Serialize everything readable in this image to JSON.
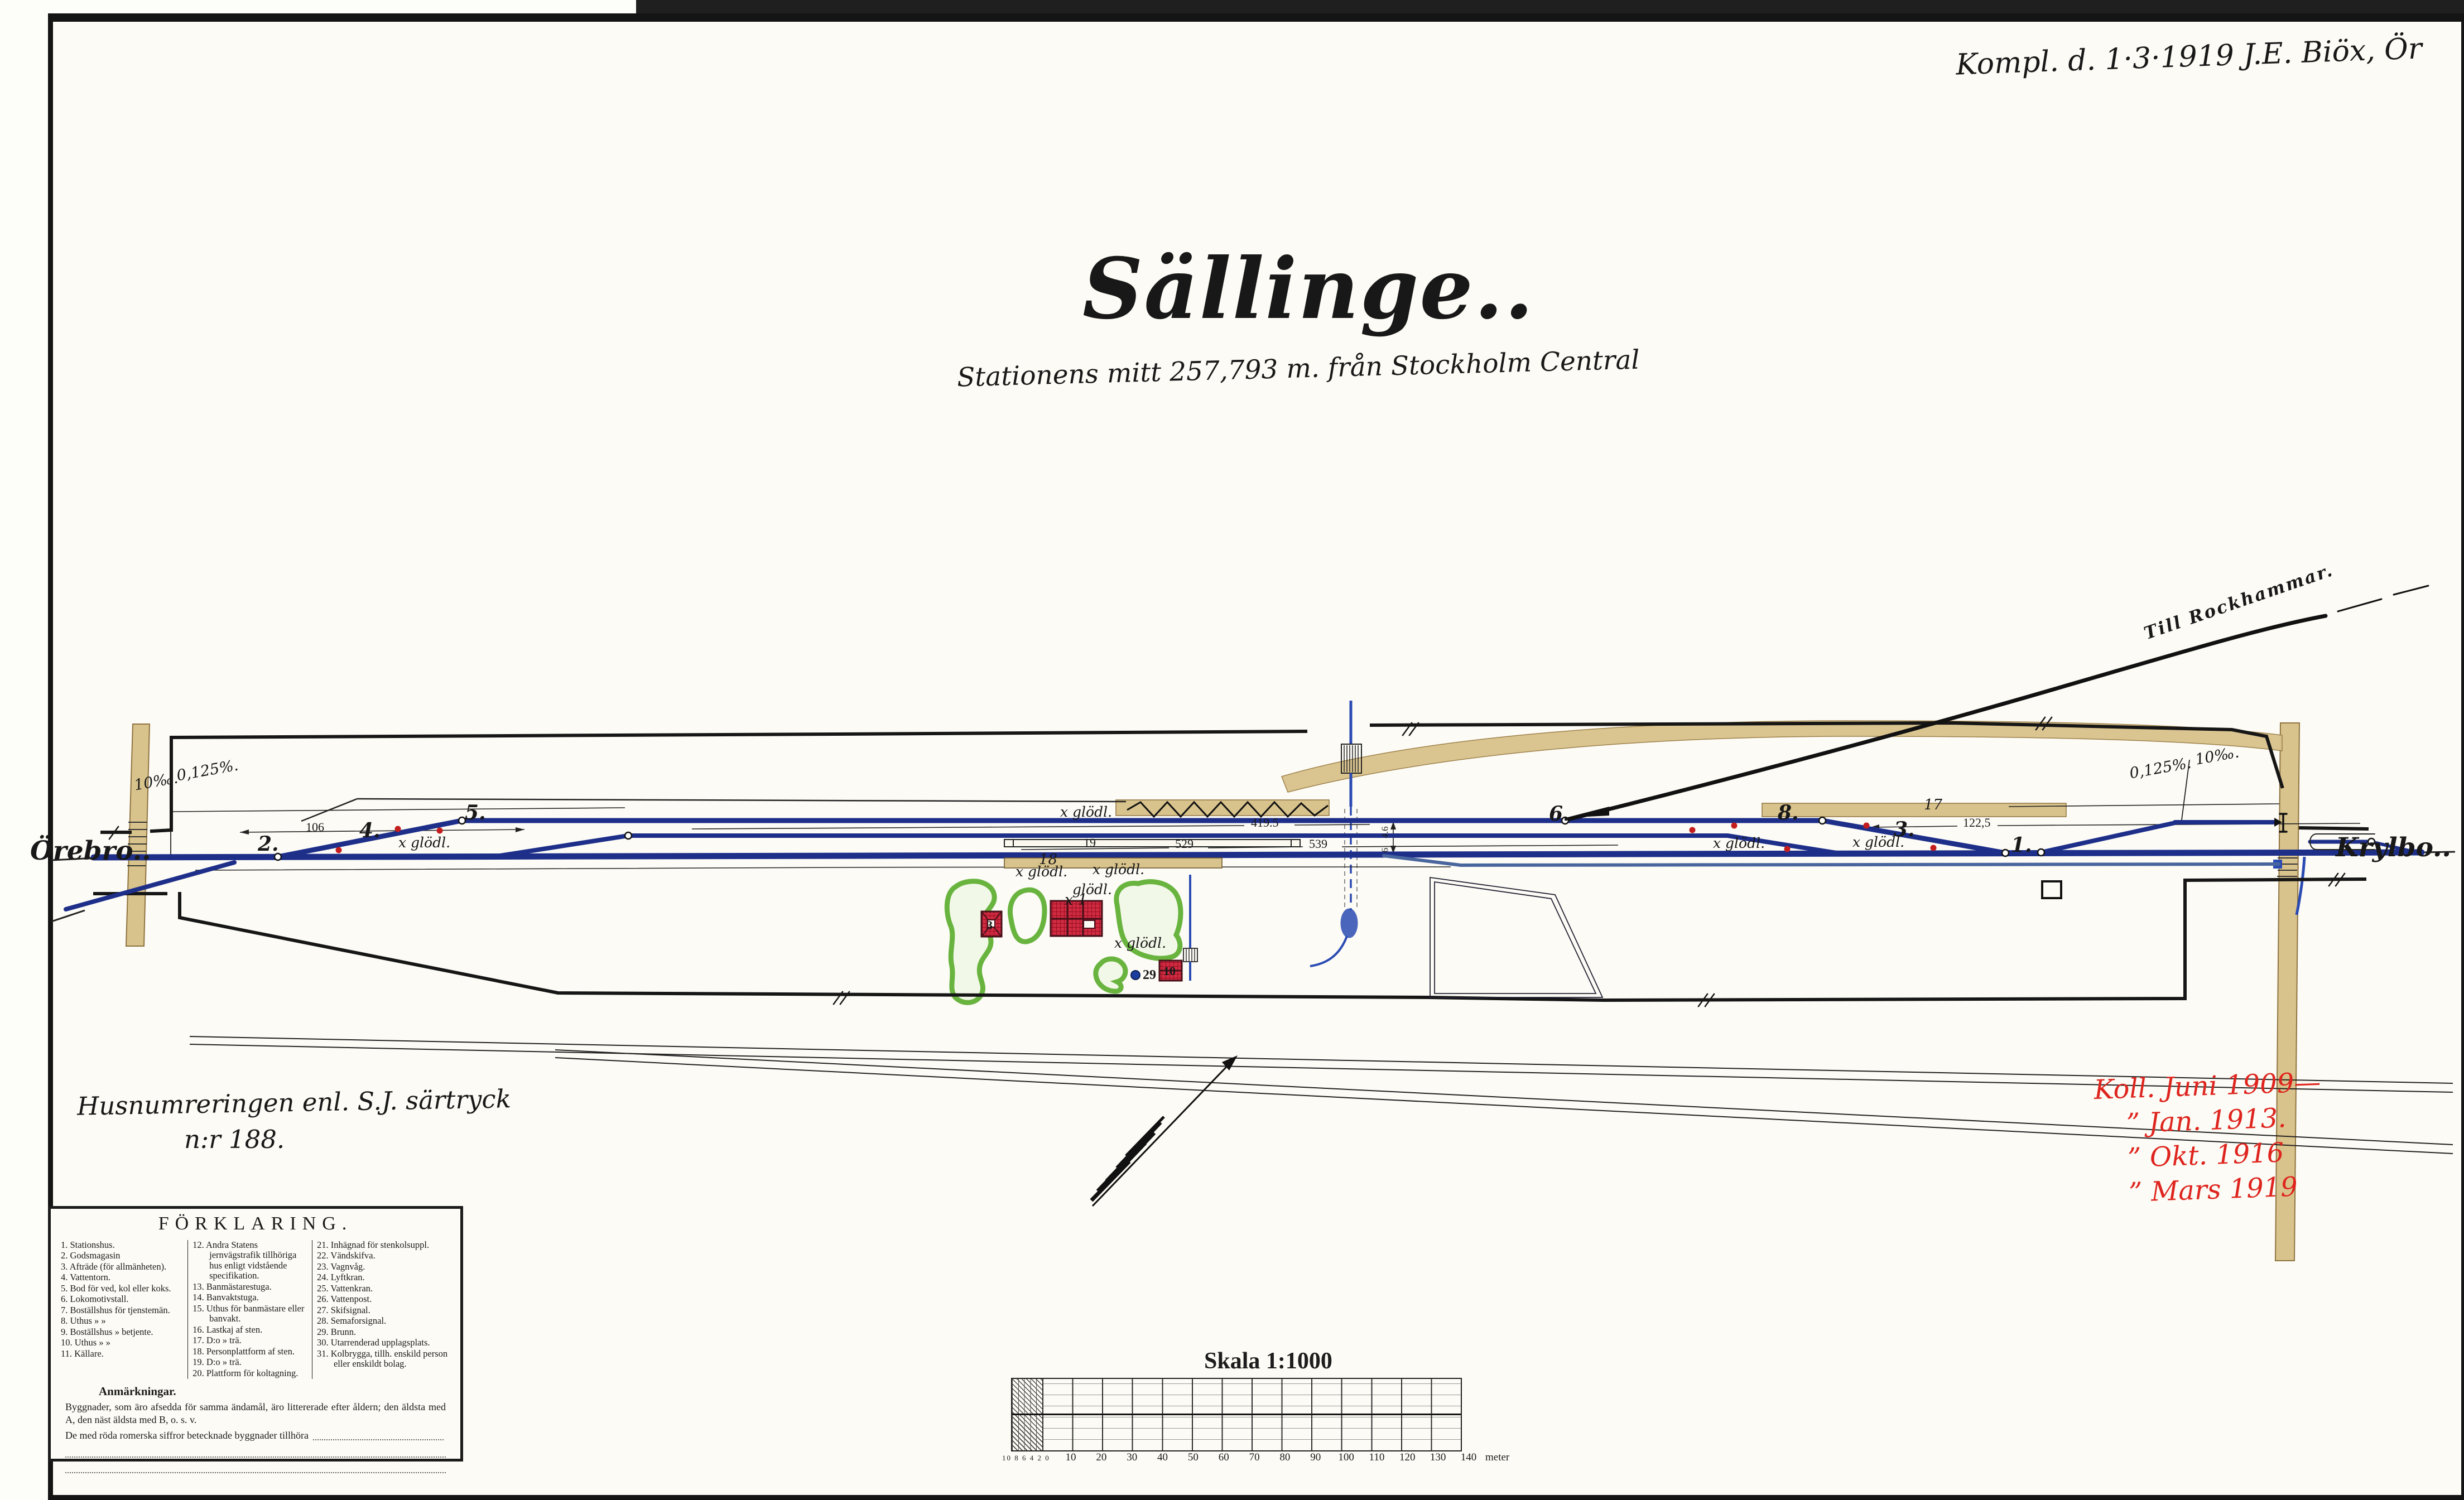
{
  "header": {
    "revision_note": "Kompl. d. 1·3·1919  J.E.  Biöx, Ör",
    "title": "Sällinge..",
    "subtitle": "Stationens mitt 257,793 m. från Stockholm Central"
  },
  "plan": {
    "left_destination": "Örebro..",
    "right_destination": "Krylbo..",
    "branch_label": "Till Rockhammar.",
    "gradients": {
      "left_a": "10‰.",
      "left_b": "0,125%.",
      "right_a": "0,125%.",
      "right_b": "10‰."
    },
    "lamp_label": "x glödl.",
    "lamp_label_plain": "glödl.",
    "station_mark": "x 1",
    "switches": [
      "2.",
      "4.",
      "5.",
      "6.",
      "8.",
      "3.",
      "1."
    ],
    "distances": {
      "d1": "106",
      "d2": "419.5",
      "d3": "529",
      "d4": "539",
      "d5": "122,5"
    },
    "dims": {
      "a": "4.6",
      "b": "6"
    },
    "numbers": {
      "privy": "3",
      "shed": "10",
      "well": "29",
      "quay": "17",
      "platform_stone": "18",
      "platform_wood": "19"
    }
  },
  "notes": {
    "husnumrering_line1": "Husnumreringen enl. S.J. särtryck",
    "husnumrering_line2": "n:r 188.",
    "revisions": [
      "Koll. Juni 1909—",
      "”  Jan. 1913.",
      "”  Okt. 1916",
      "”  Mars 1919"
    ]
  },
  "legend": {
    "title": "FÖRKLARING.",
    "col1": [
      "1. Stationshus.",
      "2. Godsmagasin",
      "3. Afträde (för allmänheten).",
      "4. Vattentorn.",
      "5. Bod för ved, kol eller koks.",
      "6. Lokomotivstall.",
      "7. Boställshus för tjenstemän.",
      "8. Uthus  »  »",
      "9. Boställshus » betjente.",
      "10. Uthus  »  »",
      "11. Källare."
    ],
    "col2": [
      "12. Andra Statens jernvägstrafik tillhöriga hus enligt vidstående specifikation.",
      "13. Banmästarestuga.",
      "14. Banvaktstuga.",
      "15. Uthus för banmästare eller banvakt.",
      "16. Lastkaj af sten.",
      "17. D:o  »  trä.",
      "18. Personplattform af sten.",
      "19. D:o  »  trä.",
      "20. Plattform för koltagning."
    ],
    "col3": [
      "21. Inhägnad för stenkolsuppl.",
      "22. Vändskifva.",
      "23. Vagnvåg.",
      "24. Lyftkran.",
      "25. Vattenkran.",
      "26. Vattenpost.",
      "27. Skifsignal.",
      "28. Semaforsignal.",
      "29. Brunn.",
      "30. Utarrenderad upplagsplats.",
      "31. Kolbrygga, tillh. enskild person eller enskildt bolag."
    ],
    "anm_heading": "Anmärkningar.",
    "anm_p1": "Byggnader, som äro afsedda för samma ändamål, äro littererade efter åldern; den äldsta med A, den näst äldsta med B, o. s. v.",
    "anm_p2": "De med röda romerska siffror betecknade byggnader tillhöra"
  },
  "scale": {
    "title": "Skala 1:1000",
    "sub_ticks": "10 8 6 4 2 0",
    "ticks": [
      "10",
      "20",
      "30",
      "40",
      "50",
      "60",
      "70",
      "80",
      "90",
      "100",
      "110",
      "120",
      "130",
      "140"
    ],
    "unit": "meter"
  },
  "colors": {
    "track_blue": "#1e2f8a",
    "track_blue_light": "#49659e",
    "stream_blue": "#2b4bb3",
    "road_tan": "#d9c38c",
    "green": "#69b43f",
    "building_red": "#d22c42",
    "hand_red": "#df241e"
  }
}
